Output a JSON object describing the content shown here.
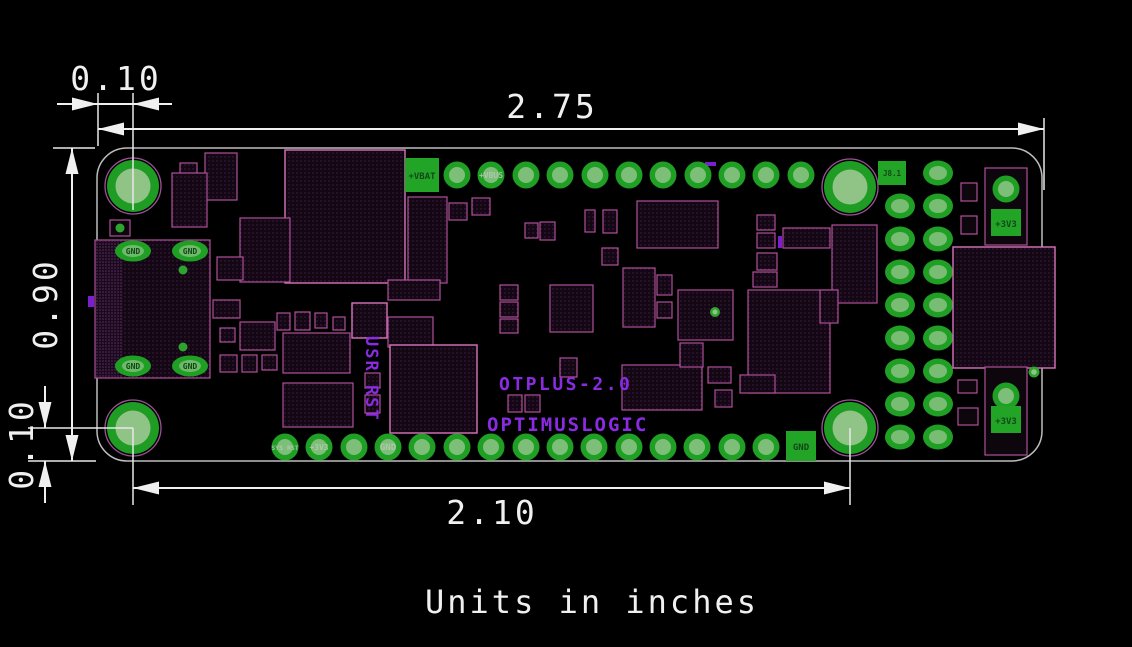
{
  "drawing": {
    "units_note": "Units in inches",
    "dims": {
      "board_width": "2.75",
      "board_height": "0.90",
      "hole_offset_x": "0.10",
      "hole_offset_y": "0.10",
      "hole_span": "2.10"
    },
    "silkscreen": {
      "product": "OTPLUS-2.0",
      "brand": "OPTIMUSLOGIC",
      "buttons": "USR RST"
    },
    "pad_labels": {
      "vbat": "+VBAT",
      "vbus": "+VBUS",
      "gnd": "GND",
      "sys_rst": "SYS RST",
      "p3v3": "+3V3",
      "j8_1": "J8.1"
    },
    "colors": {
      "background": "#000000",
      "board_outline": "#bdbdbd",
      "pad_green": "#1fa024",
      "pad_inner_green": "#8ec487",
      "footprint_magenta": "#b0509a",
      "silkscreen_violet": "#8a2be2",
      "dimension_white": "#f0f0f0"
    }
  }
}
